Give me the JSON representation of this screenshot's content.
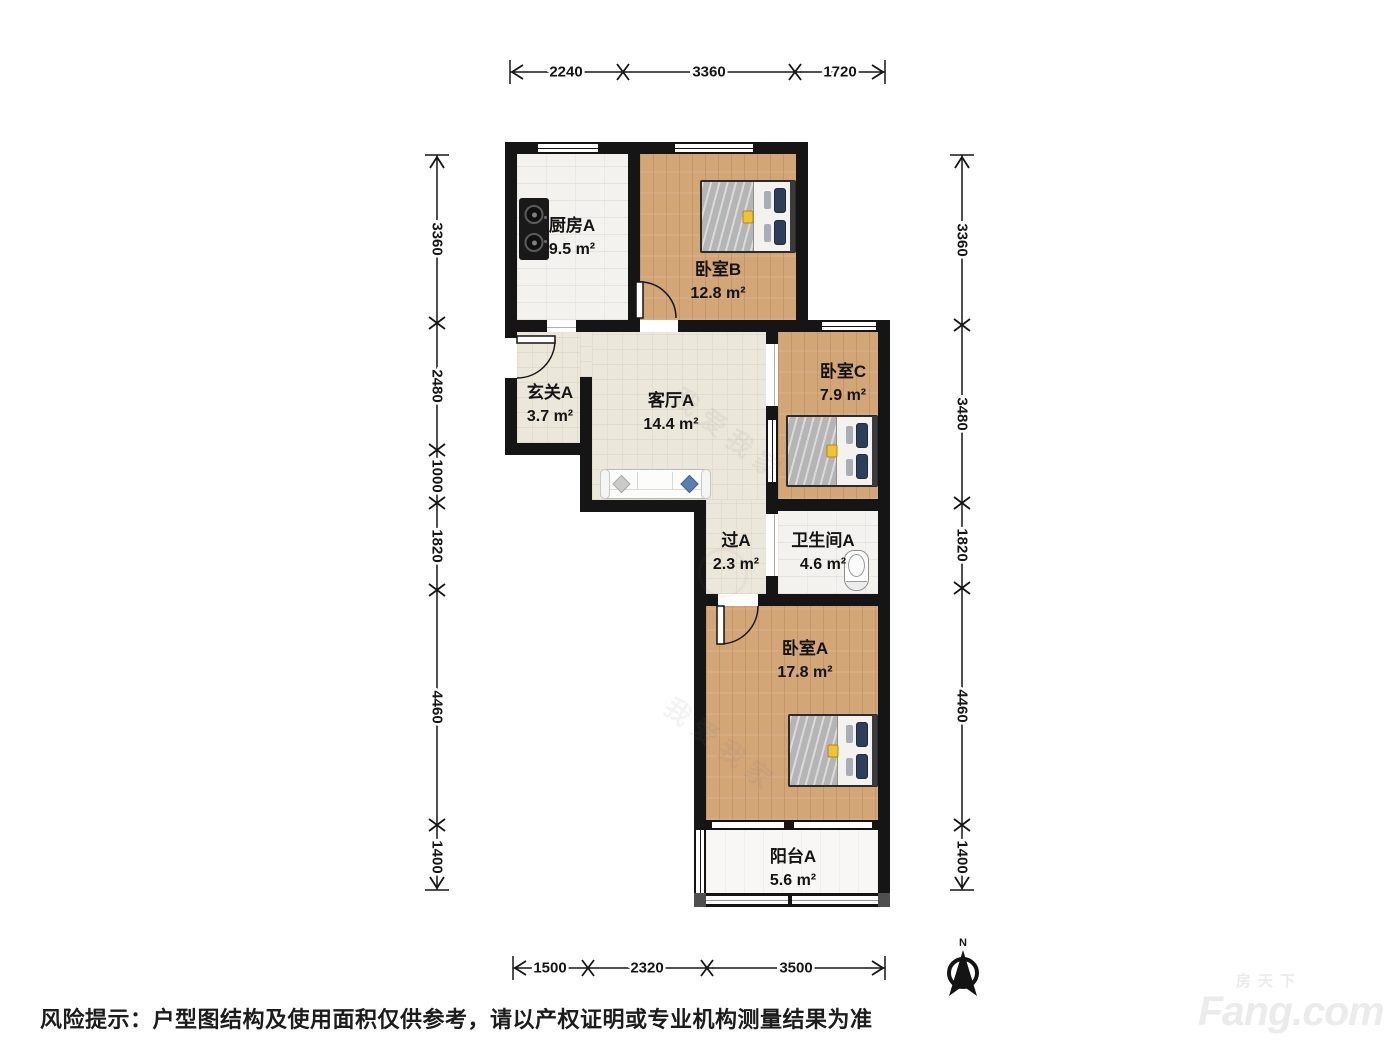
{
  "plan": {
    "rooms": [
      {
        "name": "厨房A",
        "area": "9.5 m²"
      },
      {
        "name": "卧室B",
        "area": "12.8 m²"
      },
      {
        "name": "玄关A",
        "area": "3.7 m²"
      },
      {
        "name": "客厅A",
        "area": "14.4 m²"
      },
      {
        "name": "卧室C",
        "area": "7.9 m²"
      },
      {
        "name": "过A",
        "area": "2.3 m²"
      },
      {
        "name": "卫生间A",
        "area": "4.6 m²"
      },
      {
        "name": "卧室A",
        "area": "17.8 m²"
      },
      {
        "name": "阳台A",
        "area": "5.6 m²"
      }
    ],
    "dims": {
      "top": [
        "2240",
        "3360",
        "1720"
      ],
      "left": [
        "3360",
        "2480",
        "1000",
        "1820",
        "4460",
        "1400"
      ],
      "right": [
        "3360",
        "3480",
        "1820",
        "4460",
        "1400"
      ],
      "bottom": [
        "1500",
        "2320",
        "3500"
      ]
    },
    "compass": "N"
  },
  "watermark": {
    "brand": "我爱我家"
  },
  "footer": {
    "disclaimer": "风险提示：户型图结构及使用面积仅供参考，请以产权证明或专业机构测量结果为准"
  },
  "branding": {
    "cn": "房天下",
    "en": "Fang.com"
  },
  "colors": {
    "wall": "#151515",
    "wood": "#d3a678",
    "beige": "#ece7db",
    "tile": "#f3f2ee",
    "pillow_navy": "#2d3e5a",
    "accent_yellow": "#eec437",
    "sofa_pillow_blue": "#5b7fb2"
  }
}
